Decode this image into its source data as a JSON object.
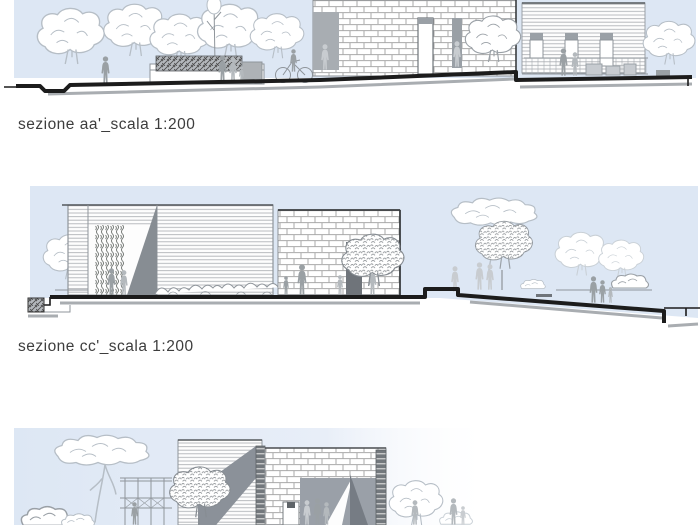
{
  "page": {
    "kind": "architectural section sheet",
    "background": "#ffffff"
  },
  "captions": {
    "section_aa": "sezione aa'_scala 1:200",
    "section_cc": "sezione cc'_scala 1:200"
  },
  "sections": [
    {
      "id": "aa",
      "label": "sezione aa'",
      "scale": "1:200"
    },
    {
      "id": "cc",
      "label": "sezione cc'",
      "scale": "1:200"
    },
    {
      "id": "third",
      "label": "",
      "scale": ""
    }
  ],
  "colors": {
    "paper": "#ffffff",
    "sky": "#dde7f4",
    "sky-light": "#eaf0f9",
    "ink": "#1c1c1c",
    "ground-shadow": "#a9adb1",
    "text": "#3d3d3d",
    "line-gray": "#8f959b",
    "shadow-gray": "#878d93",
    "figure-gray": "#9aa0a4"
  }
}
